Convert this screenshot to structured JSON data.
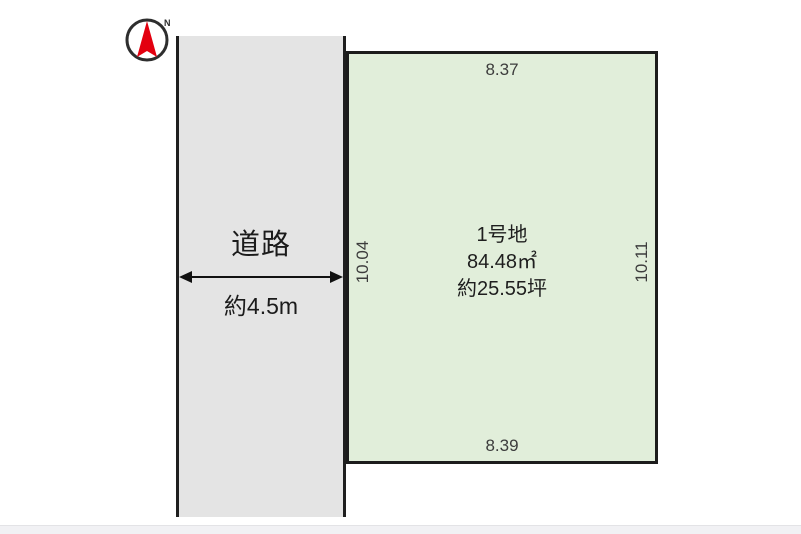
{
  "compass": {
    "label": "N"
  },
  "road": {
    "name": "道路",
    "width_label": "約4.5m"
  },
  "plot": {
    "title": "1号地",
    "area_sqm": "84.48㎡",
    "area_tsubo": "約25.55坪",
    "dim_top": "8.37",
    "dim_bottom": "8.39",
    "dim_left": "10.04",
    "dim_right": "10.11"
  },
  "colors": {
    "plot_fill": "#e1eeda",
    "road_fill": "#e4e4e4",
    "border": "#1c1c1c",
    "north_arrow_red": "#e3000f",
    "footer_band": "#f1f1f4"
  }
}
